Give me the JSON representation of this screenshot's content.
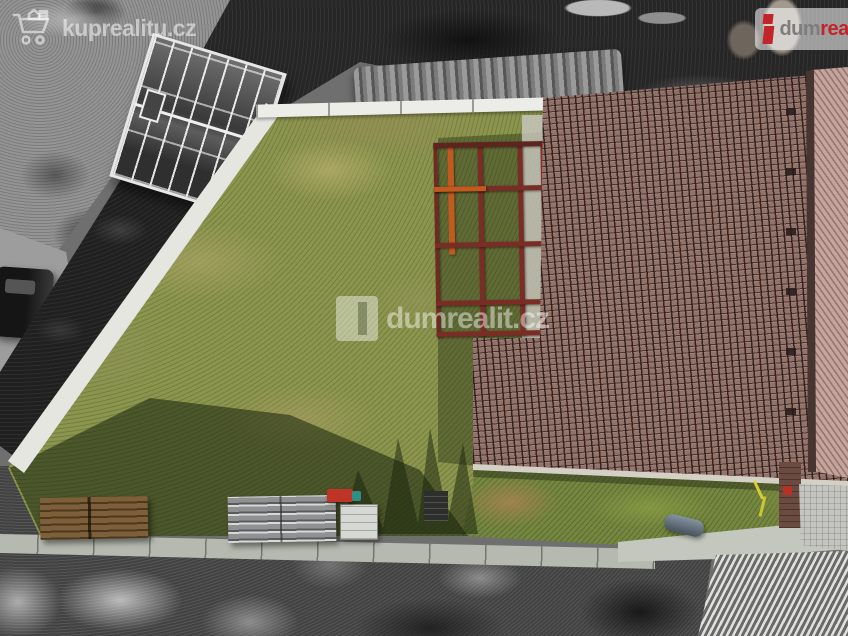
{
  "meta": {
    "type": "aerial-drone-photo",
    "subject": "building plot with family-house roof, lawn and pergola; surroundings desaturated",
    "width": 848,
    "height": 636
  },
  "watermarks": {
    "top_left": {
      "label": "kuprealitu.cz",
      "icon": "shopping-cart-icon"
    },
    "center": {
      "label": "dumrealit.cz",
      "icon": "dumrealit-square-logo"
    },
    "top_right": {
      "icon": "dumrealit-i-logo",
      "brand_gray": "dum",
      "brand_red": "realit"
    }
  },
  "scene": {
    "property_colors": {
      "lawn": "#8b954e",
      "roof_tiles": "#937269",
      "roof_right_slope": "#c4a59d",
      "pergola_beams": "#7a2d25",
      "pergola_sunlit_beam": "#c05a1e",
      "boundary_curb": "#e6e6e1",
      "concrete_path": "#b5b9af"
    },
    "surroundings_grayscale": true
  }
}
